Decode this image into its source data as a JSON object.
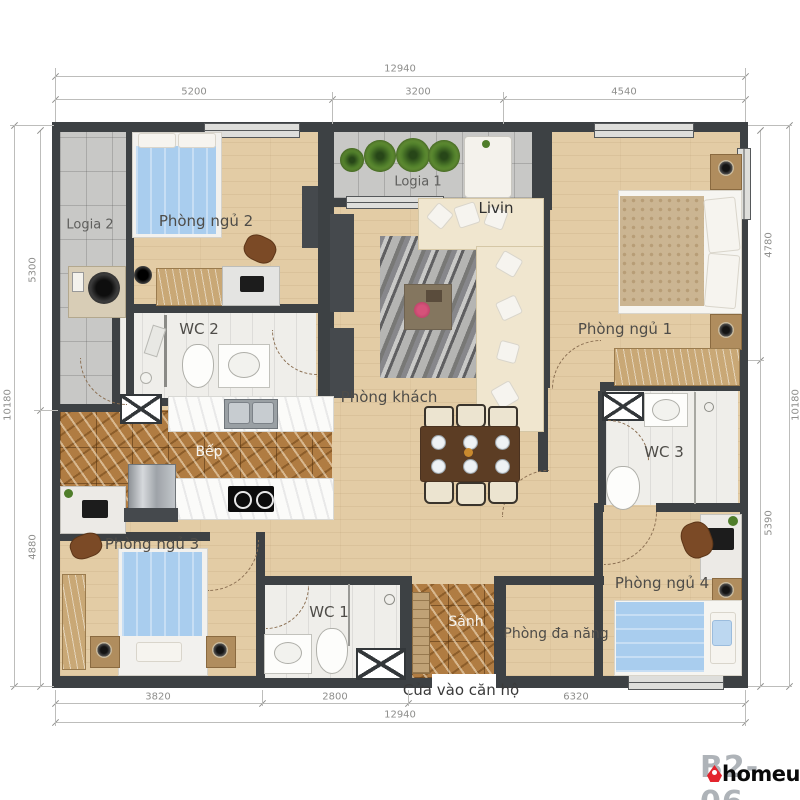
{
  "meta": {
    "unit_code": "B2-06",
    "brand": "homeup",
    "accent_color": "#e3242d",
    "wall_color": "#3d4144",
    "wood_color": "#e3cca5",
    "marble_color": "#b07c42",
    "bed_blue": "#a9cdee"
  },
  "rooms": {
    "logia1": {
      "label": "Logia 1"
    },
    "logia2": {
      "label": "Logia 2"
    },
    "bedroom1": {
      "label": "Phòng ngủ 1"
    },
    "bedroom2": {
      "label": "Phòng ngủ 2"
    },
    "bedroom3": {
      "label": "Phòng ngủ 3"
    },
    "bedroom4": {
      "label": "Phòng ngủ 4"
    },
    "living": {
      "label": "Phòng khách",
      "note": "Livin"
    },
    "kitchen": {
      "label": "Bếp"
    },
    "wc1": {
      "label": "WC 1"
    },
    "wc2": {
      "label": "WC 2"
    },
    "wc3": {
      "label": "WC 3"
    },
    "hall": {
      "label": "Sảnh"
    },
    "multipurpose": {
      "label": "Phòng đa năng"
    },
    "entrance": {
      "label": "Cửa vào căn hộ"
    }
  },
  "dimensions": {
    "top_overall": "12940",
    "top_segments": [
      "5200",
      "3200",
      "4540"
    ],
    "bottom_overall": "12940",
    "bottom_segments": [
      "3820",
      "2800",
      "6320"
    ],
    "left_overall": "10180",
    "left_segments": [
      "5300",
      "4880"
    ],
    "right_overall": "10180",
    "right_segments": [
      "4780",
      "5390"
    ]
  },
  "icons": {
    "washing-machine-icon": "dark drum circle",
    "plant-icon": "green radial circle",
    "toilet-icon": "white oval pan",
    "sink-icon": "basin with oval bowl",
    "stove-icon": "black hob with 2 burners",
    "fridge-icon": "steel box",
    "sofa-icon": "L-shaped cream sofa",
    "dining-table-icon": "table with 6 plates",
    "bed-icon": "bed with duvet and pillows",
    "lamp-icon": "round bedside lamp",
    "tv-icon": "dark media panel",
    "shaft-icon": "crossed white box",
    "door-icon": "dashed quarter-circle swing",
    "window-icon": "double-line glazing",
    "shower-icon": "glass line with head"
  }
}
